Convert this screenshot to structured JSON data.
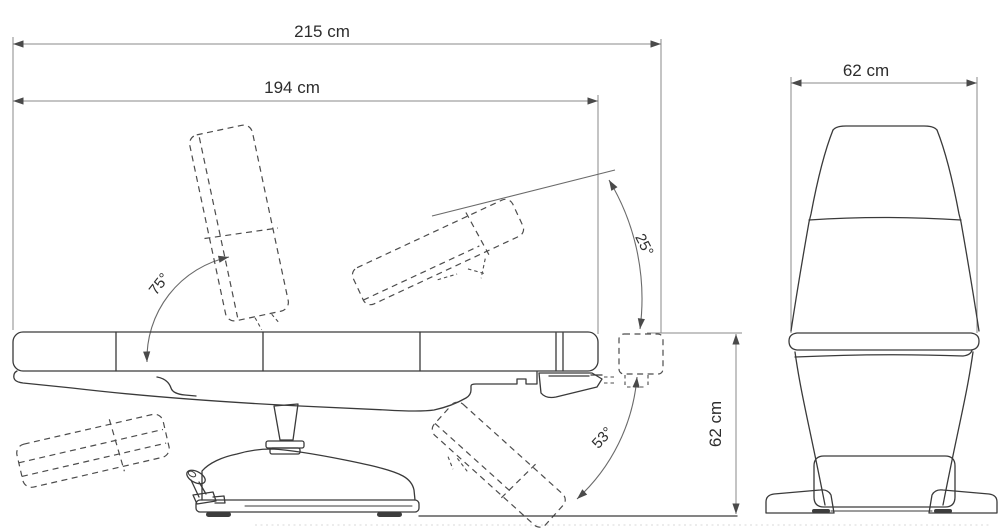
{
  "diagram": {
    "type": "technical-dimension-drawing",
    "subject": "treatment chair with reclining backrest and legrest",
    "background": "#ffffff",
    "line_color": "#3a3a3a",
    "dim_line_color": "#8a8a8a",
    "text_color": "#2d2d2d"
  },
  "side_view": {
    "overall_length": "215 cm",
    "lying_length": "194 cm",
    "seat_height": "62 cm",
    "backrest_angle": "75°",
    "legrest_raise_angle": "25°",
    "legrest_lower_angle": "53°"
  },
  "front_view": {
    "width": "62 cm"
  }
}
